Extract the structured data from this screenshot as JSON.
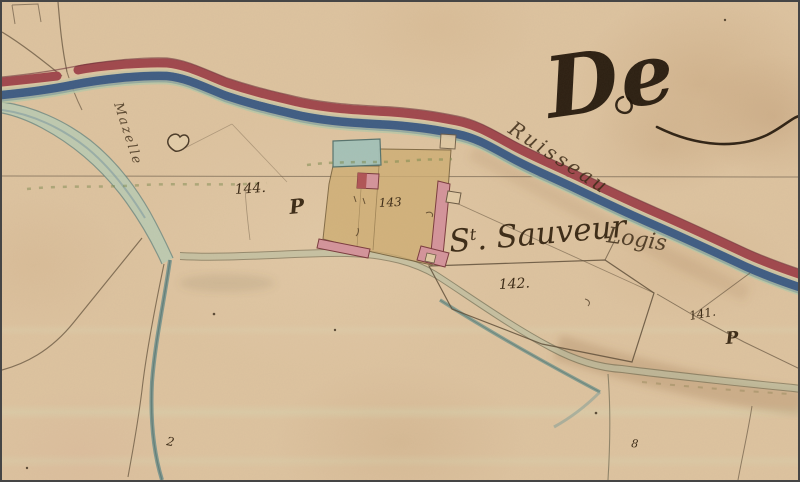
{
  "map": {
    "flourish_text": "De",
    "stream_label": "Ruisseau",
    "canal_label": "Mazelle",
    "place": {
      "prefix": "S",
      "sup": "t",
      "rest": ". Sauveur",
      "suffix": "Logis"
    },
    "parcels": [
      {
        "number": "144.",
        "symbol": "P"
      },
      {
        "number": "143",
        "symbol": ""
      },
      {
        "number": "142.",
        "symbol": ""
      },
      {
        "number": "141.",
        "symbol": "P"
      }
    ],
    "marks": {
      "left_squiggle": "2",
      "right_squiggle": "8"
    },
    "colors": {
      "paper": "#ddc3a0",
      "road_red": "#a0474d",
      "road_red_dark": "#6a3038",
      "stream_blue": "#3e5c84",
      "stream_teal": "#7fa0a0",
      "canal_green": "#b9cbb4",
      "parcel_tan": "#cfae74",
      "building_pink": "#d4949c",
      "building_red": "#b05456",
      "pond_blue": "#a3c2ba",
      "ink": "#3b2a16",
      "flourish_ink": "#1d1207",
      "line_brown": "#6b5a44"
    }
  }
}
